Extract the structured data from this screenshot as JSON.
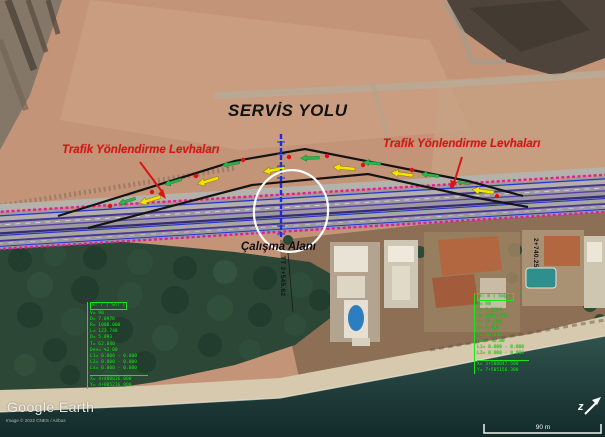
{
  "map": {
    "source_logo": "Google Earth",
    "attribution": "Image © 2022 CNES / Airbus",
    "scale_bar_label": "90 m",
    "north_glyph": "z"
  },
  "annotations": {
    "title": "SERVİS YOLU",
    "left_sign_label": "Trafik Yönlendirme Levhaları",
    "right_sign_label": "Trafik Yönlendirme Levhaları",
    "work_area_label": "Çalışma Alanı",
    "station_center": "TT 2+545.62",
    "station_right": "2+740.25"
  },
  "curve_table_left": {
    "header": "S: 7 ( Sol )",
    "lines": [
      "V= 90",
      "D= 7.0976",
      "R= 1000.000",
      "L= 123.748",
      "D= 5.093",
      "T= 62.040",
      "Dev= %2.00",
      "L1= 0.000 - 0.000",
      "L2= 0.000 - 0.000",
      "Ls= 0.000 - 0.000"
    ],
    "footer1": "X= 4+480836.000",
    "footer2": "Y= 4+085236.000"
  },
  "curve_table_right": {
    "header": "S: 8 ( Sağ )",
    "lines": [
      "V= 90",
      "D= 5.0956",
      "R= 1000.000",
      "L= 97.408",
      "D= 4.093",
      "T= 48.640",
      "Dev= %2.00",
      "L1= 0.000 - 0.000",
      "L2= 0.000 - 0.000"
    ],
    "footer1": "X= 3+500047.500",
    "footer2": "Y= 7+505156.300"
  },
  "colors": {
    "guardrail_magenta": "#df1f9b",
    "lane_blue": "#2336cf",
    "lane_purple": "#4a3594",
    "detour_black": "#141414",
    "sign_green": "#2ab54a",
    "arrow_yellow": "#f2e300",
    "accent_red": "#d91616",
    "cad_green": "#17e617"
  }
}
